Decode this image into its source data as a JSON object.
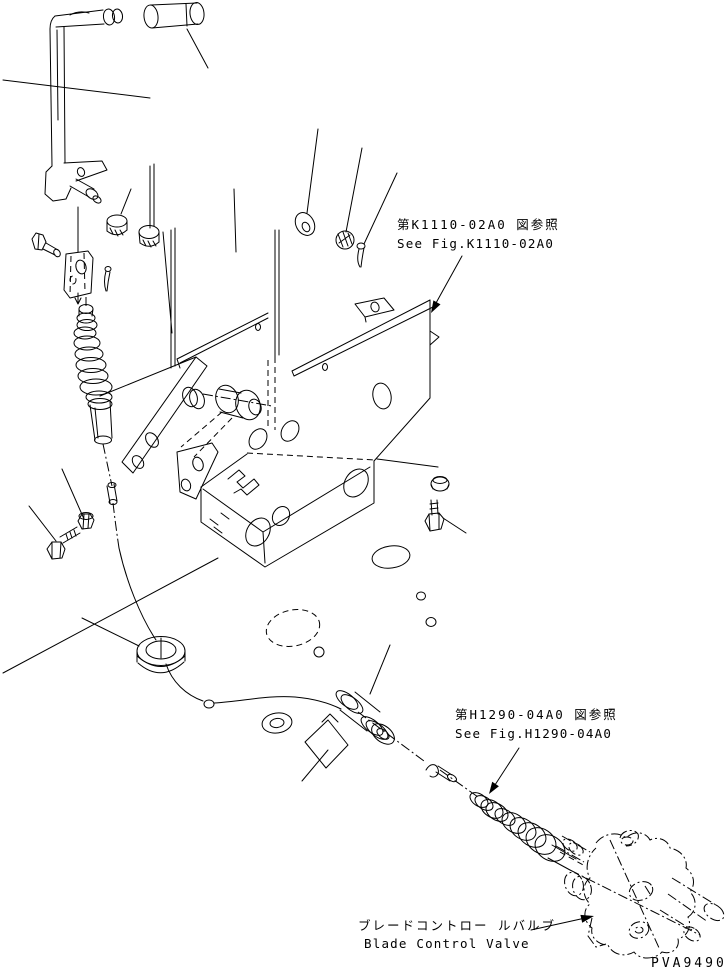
{
  "figure": {
    "background_color": "#ffffff",
    "line_color": "#000000",
    "code": "PVA9490",
    "callouts": {
      "k1110": {
        "jp": "第K1110-02A0 図参照",
        "en": "See Fig.K1110-02A0"
      },
      "h1290": {
        "jp": "第H1290-04A0 図参照",
        "en": "See Fig.H1290-04A0"
      },
      "valve": {
        "jp": "ブレードコントロー ルバルブ",
        "en": "Blade Control Valve"
      }
    }
  }
}
